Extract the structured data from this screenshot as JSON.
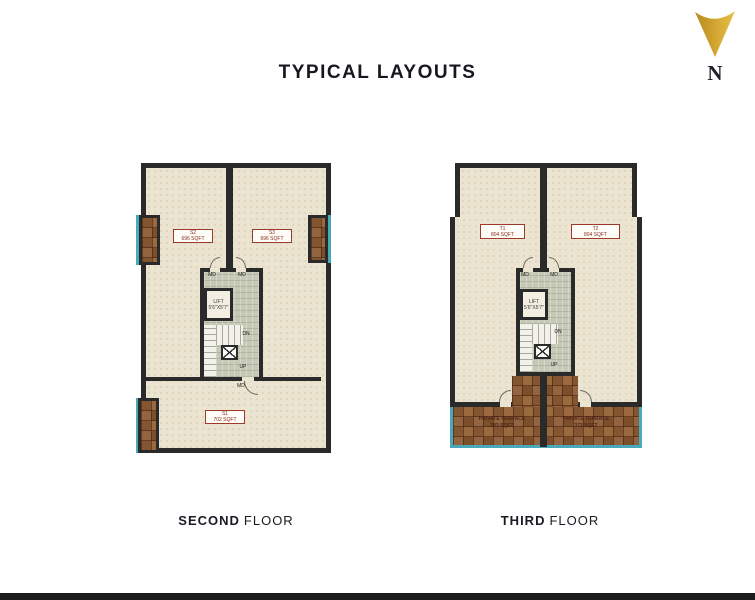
{
  "title": "TYPICAL LAYOUTS",
  "compass": {
    "letter": "N"
  },
  "plans": [
    {
      "caption_bold": "SECOND",
      "caption_rest": "FLOOR",
      "units": [
        {
          "code": "S2",
          "area": "696 SQFT"
        },
        {
          "code": "S3",
          "area": "696 SQFT"
        },
        {
          "code": "S1",
          "area": "702 SQFT"
        }
      ],
      "core": {
        "lift": "LIFT",
        "lift_size": "5'6\"X5'7\"",
        "door": "MD",
        "dn": "DN",
        "up": "UP"
      }
    },
    {
      "caption_bold": "THIRD",
      "caption_rest": "FLOOR",
      "units": [
        {
          "code": "T1",
          "area": "804 SQFT"
        },
        {
          "code": "T2",
          "area": "804 SQFT"
        }
      ],
      "terraces": [
        {
          "name": "PRIVATE TERRACE",
          "area": "383 SQFT"
        },
        {
          "name": "PRIVATE TERRACE",
          "area": "372 SQFT"
        }
      ],
      "core": {
        "lift": "LIFT",
        "lift_size": "5'6\"X5'7\"",
        "door": "MD",
        "dn": "DN",
        "up": "UP"
      }
    }
  ]
}
